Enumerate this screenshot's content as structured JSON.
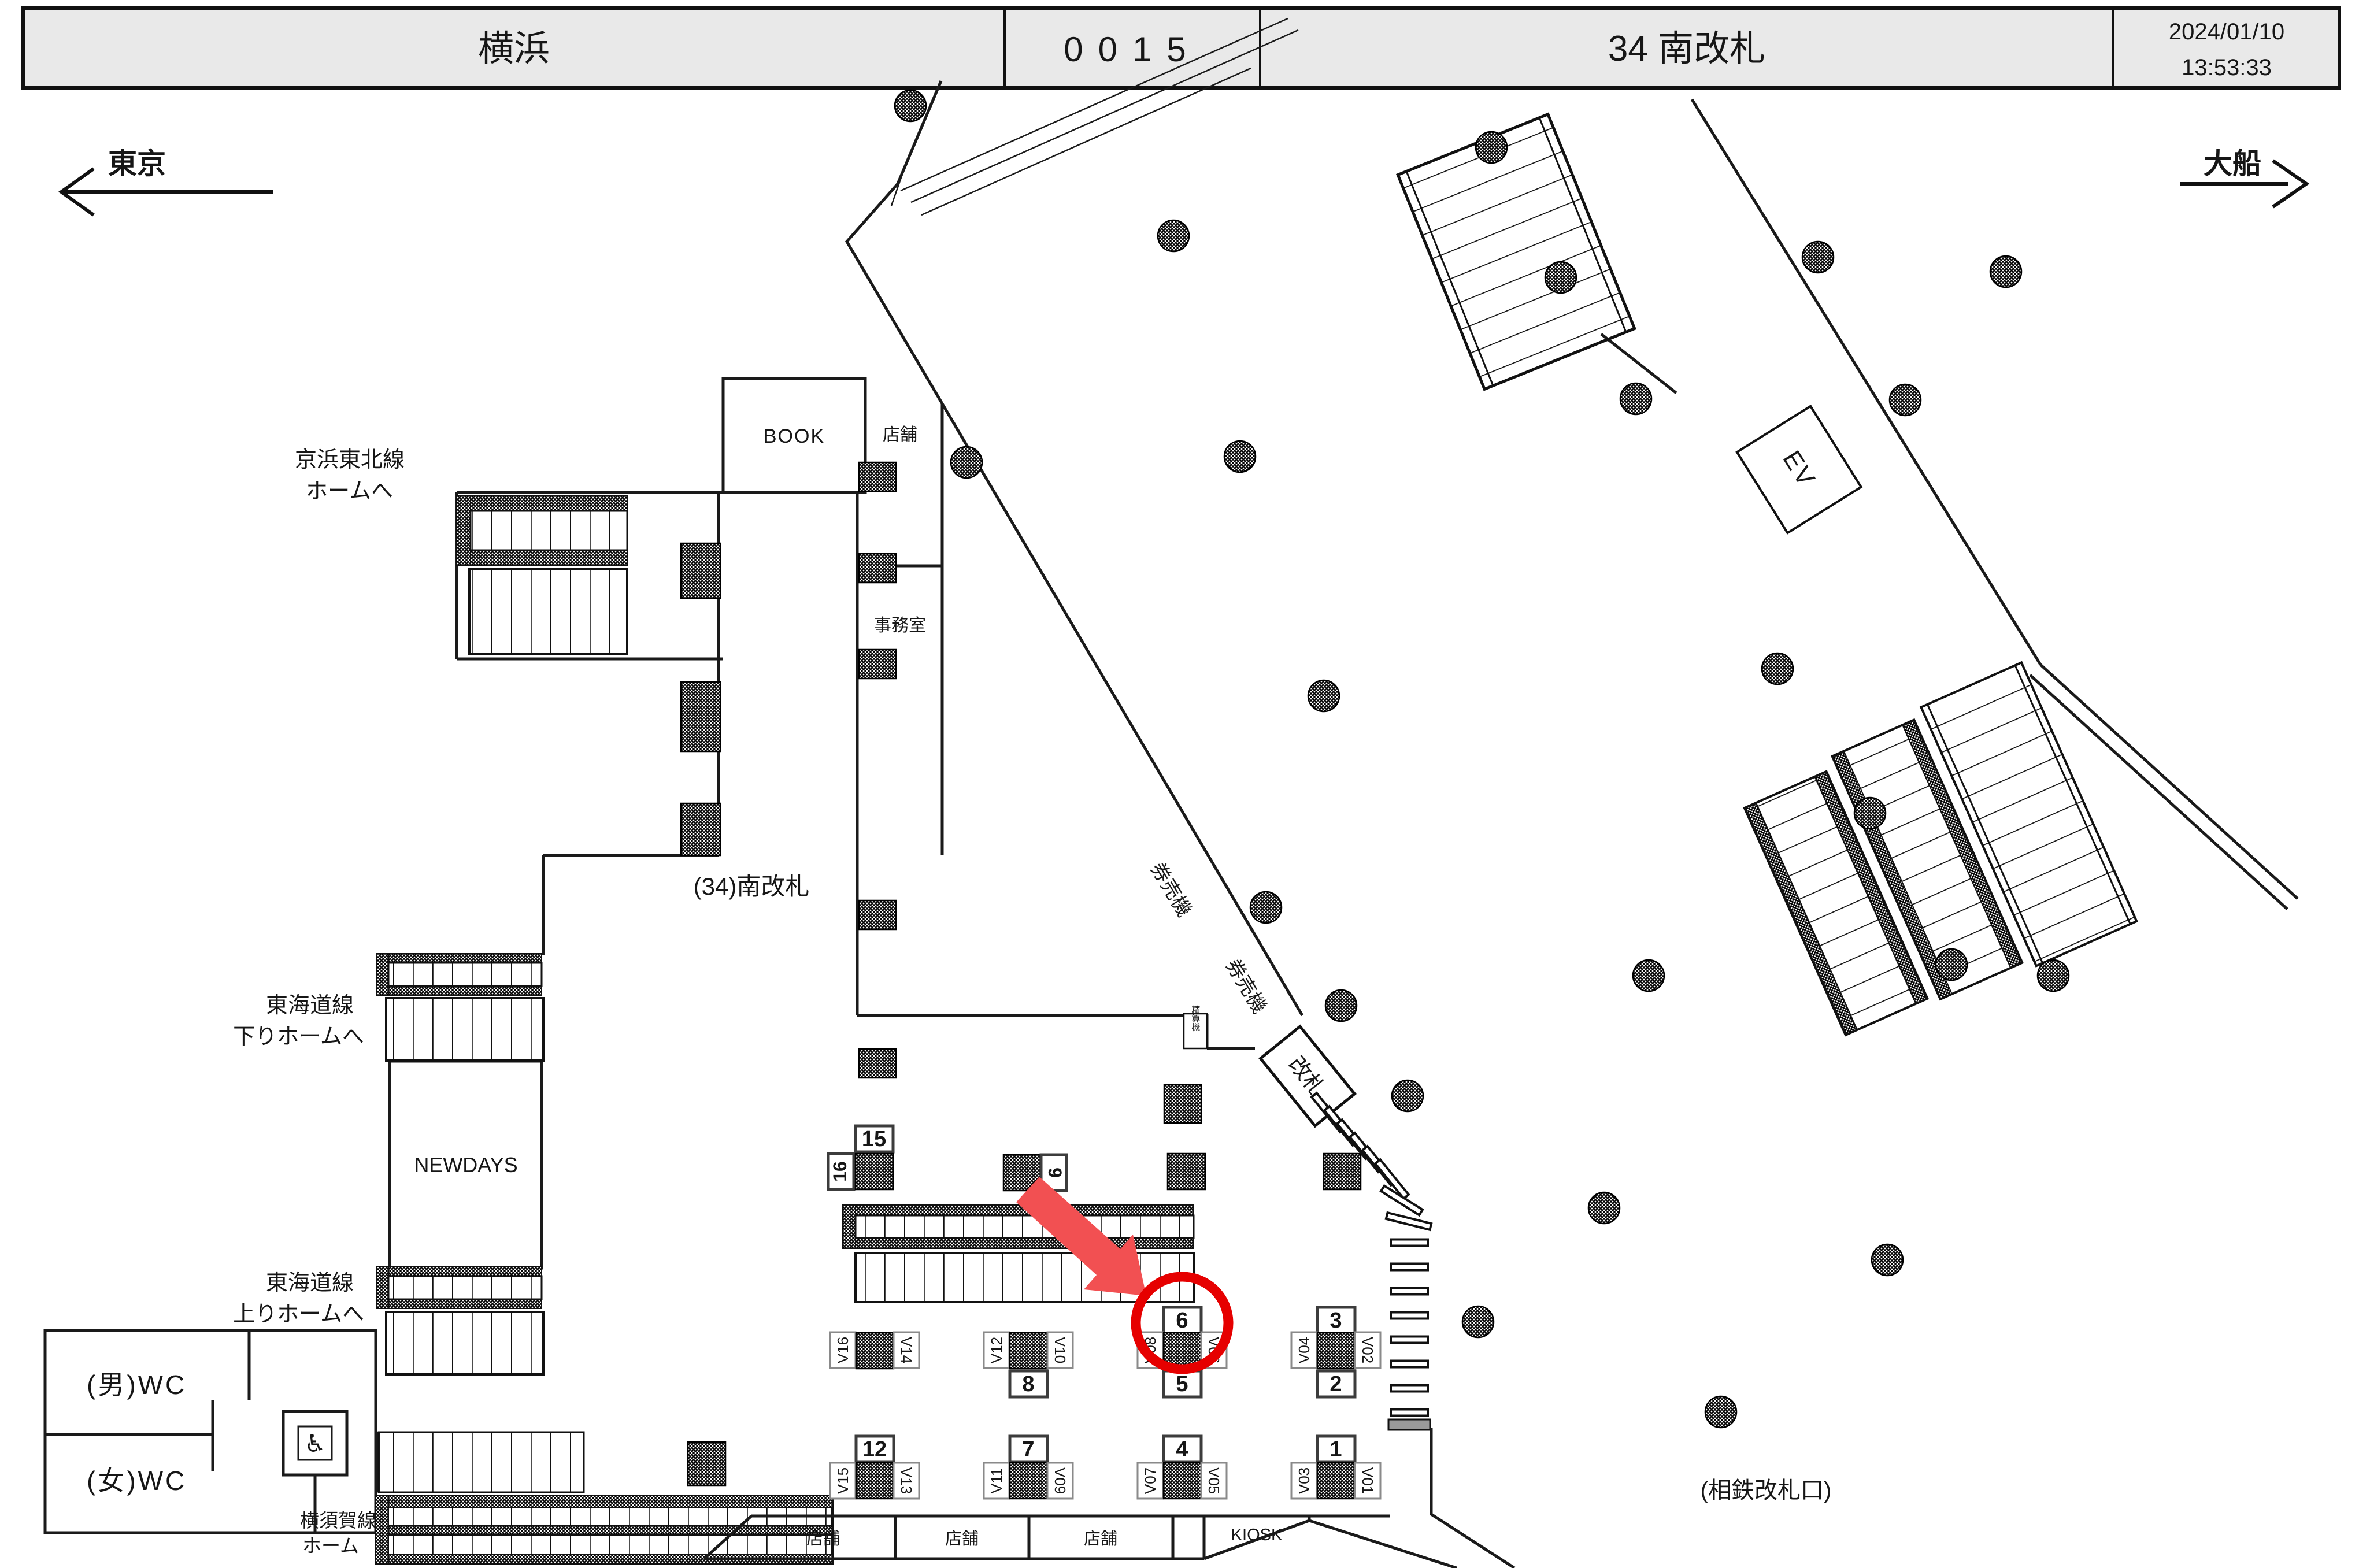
{
  "header": {
    "station": "横浜",
    "train_no": "0015",
    "location": "34 南改札",
    "date": "2024/01/10",
    "time": "13:53:33"
  },
  "directions": {
    "left": "東京",
    "right": "大船"
  },
  "areas": {
    "book": "BOOK",
    "shop": "店舗",
    "office": "事務室",
    "gate_name": "(34)南改札",
    "keihin_tohoku_line1": "京浜東北線",
    "keihin_tohoku_line2": "ホームへ",
    "tokaido_down_line1": "東海道線",
    "tokaido_down_line2": "下りホームへ",
    "newdays": "NEWDAYS",
    "tokaido_up_line1": "東海道線",
    "tokaido_up_line2": "上りホームへ",
    "wc_men": "(男)WC",
    "wc_women": "(女)WC",
    "yokosuka_line1": "横須賀線",
    "yokosuka_line2": "ホーム",
    "ticket_machines1": "券売機",
    "ticket_machines2": "券売機",
    "fare_adjustment": "精算機",
    "gate": "改札",
    "elevator": "EV",
    "shop1": "店舗",
    "shop2": "店舗",
    "shop3": "店舗",
    "kiosk": "KIOSK",
    "sotetsu_gate": "(相鉄改札口)",
    "wheelchair_icon": "♿"
  },
  "camera_units": {
    "mid": [
      {
        "top": "15",
        "left": "16"
      },
      {
        "right": "9"
      }
    ],
    "upper": [
      {
        "left": "V16",
        "right": "V14"
      },
      {
        "left": "V12",
        "right": "V10",
        "bottom": "8"
      },
      {
        "top": "6",
        "left": "V08",
        "right": "V06",
        "bottom": "5"
      },
      {
        "top": "3",
        "left": "V04",
        "right": "V02",
        "bottom": "2"
      }
    ],
    "lower": [
      {
        "top": "12",
        "left": "V15",
        "right": "V13"
      },
      {
        "top": "7",
        "left": "V11",
        "right": "V09"
      },
      {
        "top": "4",
        "left": "V07",
        "right": "V05"
      },
      {
        "top": "1",
        "left": "V03",
        "right": "V01"
      }
    ]
  },
  "highlight": {
    "circled_label": "6"
  },
  "colors": {
    "highlight_red": "#e60000",
    "arrow_red": "#f25052",
    "header_bg": "#e9e9e9",
    "line": "#1a1a1a"
  }
}
